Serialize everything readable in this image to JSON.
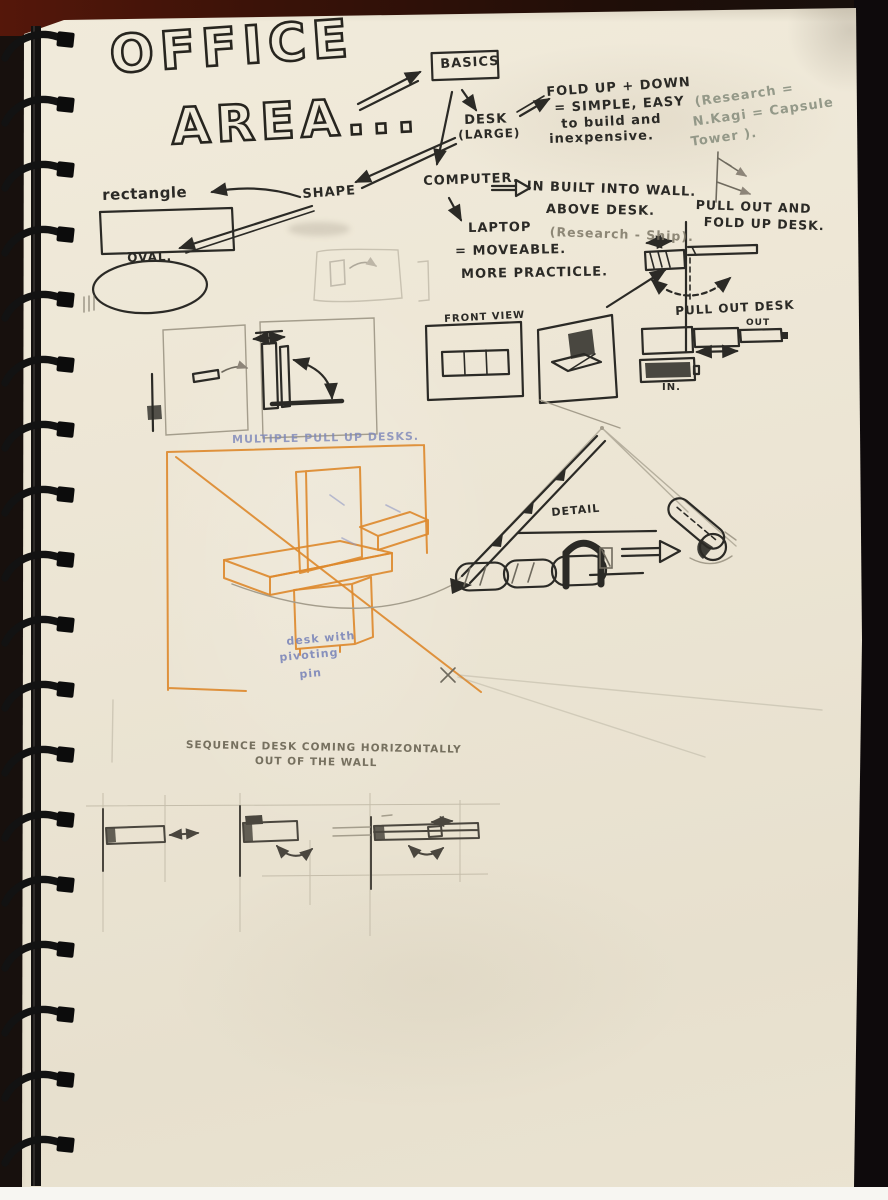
{
  "notebook": {
    "title": {
      "line1": "OFFICE",
      "line2": "AREA..."
    },
    "nodes": {
      "basics": "BASICS",
      "desk": "DESK",
      "desk_size": "(LARGE)",
      "computer": "COMPUTER.",
      "shape": "SHAPE",
      "rectangle": "rectangle",
      "oval": "OVAL."
    },
    "notes": {
      "fold": [
        "FOLD UP + DOWN",
        "= SIMPLE, EASY",
        "to build and",
        "inexpensive."
      ],
      "research": [
        "(Research =",
        "N.Kagi = Capsule",
        "Tower )."
      ],
      "wall": [
        "IN BUILT INTO WALL.",
        "ABOVE DESK."
      ],
      "research_ship": "(Research - Ship).",
      "laptop": [
        "LAPTOP",
        "= MOVEABLE.",
        "MORE PRACTICLE."
      ],
      "pull_fold": [
        "PULL OUT AND",
        "FOLD UP DESK."
      ],
      "pull_out": "PULL OUT DESK",
      "pull_out_sub": "OUT",
      "in_label": "IN.",
      "front_view": "FRONT VIEW",
      "multiple": "MULTIPLE PULL UP DESKS.",
      "pivot": [
        "desk with",
        "pivoting",
        "pin"
      ],
      "detail": "DETAIL",
      "sequence": [
        "SEQUENCE DESK COMING HORIZONTALLY",
        "OUT OF THE WALL"
      ]
    },
    "colors": {
      "ink": "#2b2a26",
      "pencil": "#8d877a",
      "orange": "#dd8a2f",
      "blue": "#7b85b8",
      "green_pencil": "#8b9184",
      "paper": "#ebe4d3"
    }
  }
}
